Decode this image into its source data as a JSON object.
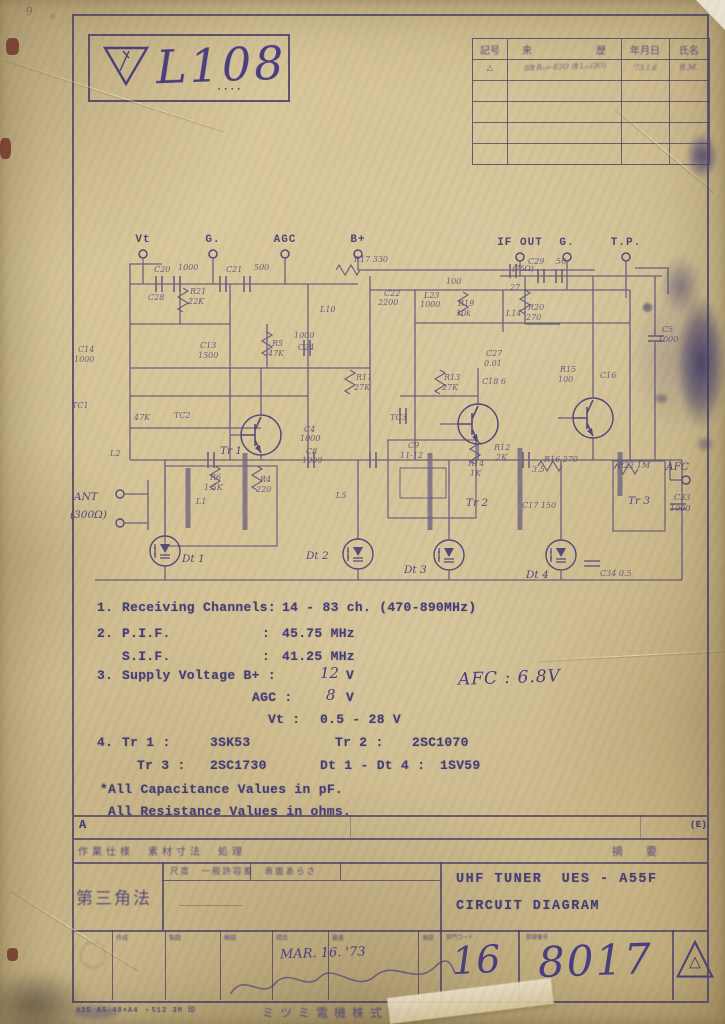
{
  "logo": {
    "number": "L108",
    "stamp_dots": "▪▪▪▪"
  },
  "margin_notes": {
    "m1": "9",
    "m2": "o"
  },
  "revision_table": {
    "headers": {
      "mark": "記号",
      "history_l": "来",
      "history_r": "歴",
      "date": "年月日",
      "name": "氏名"
    },
    "row1": {
      "mark": "△",
      "note": "ﾛ改 R₁₃←E2O 改 L₁₀(3O)",
      "date": "'73.1.6",
      "name": "R.M."
    }
  },
  "schematic": {
    "ink": "#4e4478",
    "terminals_top": [
      {
        "label": "Vt",
        "x": 73,
        "ly": 14,
        "cy": 26
      },
      {
        "label": "G.",
        "x": 143,
        "ly": 14,
        "cy": 26
      },
      {
        "label": "AGC",
        "x": 215,
        "ly": 14,
        "cy": 26
      },
      {
        "label": "B+",
        "x": 288,
        "ly": 14,
        "cy": 26
      },
      {
        "label": "IF OUT",
        "x": 450,
        "ly": 17,
        "cy": 29,
        "sub": "(75Ω)"
      },
      {
        "label": "G.",
        "x": 497,
        "ly": 17,
        "cy": 29
      },
      {
        "label": "T.P.",
        "x": 556,
        "ly": 17,
        "cy": 29
      }
    ],
    "ant": {
      "line1": "ANT",
      "line2": "(300Ω)"
    },
    "afc": {
      "label": "AFC"
    },
    "transistors": [
      {
        "label": "Tr 1",
        "cx": 191,
        "cy": 207,
        "lx": 150,
        "ly": 226
      },
      {
        "label": "Tr 2",
        "cx": 408,
        "cy": 196,
        "lx": 396,
        "ly": 278
      },
      {
        "label": "Tr 3",
        "cx": 523,
        "cy": 190,
        "lx": 558,
        "ly": 276
      }
    ],
    "diodes": [
      {
        "label": "Dt 1",
        "cx": 95,
        "cy": 323,
        "lx": 112,
        "ly": 334
      },
      {
        "label": "Dt 2",
        "cx": 288,
        "cy": 326,
        "lx": 236,
        "ly": 331
      },
      {
        "label": "Dt 3",
        "cx": 379,
        "cy": 327,
        "lx": 334,
        "ly": 345
      },
      {
        "label": "Dt 4",
        "cx": 491,
        "cy": 327,
        "lx": 456,
        "ly": 350
      }
    ],
    "labels": [
      {
        "t": "C20",
        "x": 84,
        "y": 44
      },
      {
        "t": "1000",
        "x": 108,
        "y": 42
      },
      {
        "t": "C21",
        "x": 156,
        "y": 44
      },
      {
        "t": "500",
        "x": 184,
        "y": 42
      },
      {
        "t": "R17 330",
        "x": 284,
        "y": 34
      },
      {
        "t": "C22",
        "x": 314,
        "y": 68
      },
      {
        "t": "2200",
        "x": 308,
        "y": 77
      },
      {
        "t": "L23",
        "x": 354,
        "y": 70
      },
      {
        "t": "1000",
        "x": 350,
        "y": 79
      },
      {
        "t": "100",
        "x": 376,
        "y": 56
      },
      {
        "t": "R19",
        "x": 388,
        "y": 78
      },
      {
        "t": "10k",
        "x": 386,
        "y": 88
      },
      {
        "t": "L14",
        "x": 436,
        "y": 88
      },
      {
        "t": "27",
        "x": 440,
        "y": 62
      },
      {
        "t": "C29",
        "x": 458,
        "y": 36
      },
      {
        "t": "56",
        "x": 486,
        "y": 36
      },
      {
        "t": "R20",
        "x": 458,
        "y": 82
      },
      {
        "t": "270",
        "x": 456,
        "y": 92
      },
      {
        "t": "C5",
        "x": 592,
        "y": 104
      },
      {
        "t": "1000",
        "x": 588,
        "y": 114
      },
      {
        "t": "C28",
        "x": 78,
        "y": 72
      },
      {
        "t": "R21",
        "x": 120,
        "y": 66
      },
      {
        "t": "22K",
        "x": 118,
        "y": 76
      },
      {
        "t": "C14",
        "x": 8,
        "y": 124
      },
      {
        "t": "1000",
        "x": 4,
        "y": 134
      },
      {
        "t": "C13",
        "x": 130,
        "y": 120
      },
      {
        "t": "1500",
        "x": 128,
        "y": 130
      },
      {
        "t": "R5",
        "x": 202,
        "y": 118
      },
      {
        "t": "47K",
        "x": 198,
        "y": 128
      },
      {
        "t": "1000",
        "x": 224,
        "y": 110
      },
      {
        "t": "C24",
        "x": 228,
        "y": 122
      },
      {
        "t": "L10",
        "x": 250,
        "y": 84
      },
      {
        "t": "R11",
        "x": 286,
        "y": 152
      },
      {
        "t": "27K",
        "x": 284,
        "y": 162
      },
      {
        "t": "TC1",
        "x": 2,
        "y": 180
      },
      {
        "t": "47K",
        "x": 64,
        "y": 192
      },
      {
        "t": "R13",
        "x": 374,
        "y": 152
      },
      {
        "t": "27K",
        "x": 372,
        "y": 162
      },
      {
        "t": "C27",
        "x": 416,
        "y": 128
      },
      {
        "t": "0.01",
        "x": 414,
        "y": 138
      },
      {
        "t": "C18 6",
        "x": 412,
        "y": 156
      },
      {
        "t": "R15",
        "x": 490,
        "y": 144
      },
      {
        "t": "100",
        "x": 488,
        "y": 154
      },
      {
        "t": "C16",
        "x": 530,
        "y": 150
      },
      {
        "t": "TC2",
        "x": 104,
        "y": 190
      },
      {
        "t": "TC3",
        "x": 320,
        "y": 192
      },
      {
        "t": "R6",
        "x": 140,
        "y": 252
      },
      {
        "t": "1.5K",
        "x": 134,
        "y": 262
      },
      {
        "t": "R4",
        "x": 190,
        "y": 254
      },
      {
        "t": "220",
        "x": 186,
        "y": 264
      },
      {
        "t": "C4",
        "x": 234,
        "y": 204
      },
      {
        "t": "1000",
        "x": 230,
        "y": 213
      },
      {
        "t": "C8",
        "x": 236,
        "y": 226
      },
      {
        "t": "1000",
        "x": 232,
        "y": 235
      },
      {
        "t": "L2",
        "x": 40,
        "y": 228
      },
      {
        "t": "L1",
        "x": 126,
        "y": 276
      },
      {
        "t": "L5",
        "x": 266,
        "y": 270
      },
      {
        "t": "C9",
        "x": 338,
        "y": 220
      },
      {
        "t": "11-12",
        "x": 330,
        "y": 230
      },
      {
        "t": "R14",
        "x": 398,
        "y": 238
      },
      {
        "t": "1K",
        "x": 400,
        "y": 248
      },
      {
        "t": "R12",
        "x": 424,
        "y": 222
      },
      {
        "t": "2K",
        "x": 426,
        "y": 232
      },
      {
        "t": "3.5",
        "x": 462,
        "y": 244
      },
      {
        "t": "R16 270",
        "x": 474,
        "y": 234
      },
      {
        "t": "C17 150",
        "x": 452,
        "y": 280
      },
      {
        "t": "R22 1M",
        "x": 548,
        "y": 240
      },
      {
        "t": "C33",
        "x": 604,
        "y": 272
      },
      {
        "t": "1000",
        "x": 600,
        "y": 283
      },
      {
        "t": "C34 0.5",
        "x": 530,
        "y": 348
      }
    ]
  },
  "specs": {
    "line1": {
      "num": "1.",
      "label": "Receiving Channels:",
      "value": "14 - 83 ch. (470-890MHz)"
    },
    "line2": {
      "num": "2.",
      "label": "P.I.F.",
      "colon": ":",
      "value": "45.75 MHz"
    },
    "line3": {
      "label": "S.I.F.",
      "colon": ":",
      "value": "41.25 MHz"
    },
    "line4": {
      "num": "3.",
      "label": "Supply Voltage B+ :",
      "hand": "12",
      "unit": "V"
    },
    "line5": {
      "label": "AGC :",
      "hand": "8",
      "unit": "V"
    },
    "line6": {
      "label": "Vt :",
      "value": "0.5 - 28 V"
    },
    "line7": {
      "num": "4.",
      "label": "Tr 1 :",
      "value": "3SK53",
      "label2": "Tr 2 :",
      "value2": "2SC1070"
    },
    "line8": {
      "label": "Tr 3 :",
      "value": "2SC1730",
      "label2": "Dt 1 - Dt 4 :",
      "value2": "1SV59"
    },
    "note1": "*All Capacitance Values in pF.",
    "note2": "All Resistance Values in ohms.",
    "afc_hand": "AFC : 6.8V"
  },
  "titleblock": {
    "row_a_label": "A",
    "process_row": "作業仕様　素材寸法　処理",
    "remark_label": "摘　要",
    "corner_note": "(E)",
    "projection_label": "第三角法",
    "scale_header": "尺度　一般許容差　表面あらさ",
    "title_line1": "UHF TUNER  UES - A55F",
    "title_line2": "CIRCUIT DIAGRAM",
    "sign_headers": [
      "作成",
      "製図",
      "検図",
      "照合",
      "審査",
      "承認"
    ],
    "dept_code_label": "部門コード",
    "dept_code": "16",
    "dwg_no_label": "登録番号",
    "dwg_no": "8017",
    "date_hand": "MAR. 16. '73",
    "footer_print": "#25 A5-48×A4 ・512 3M 印",
    "company": "ミツミ電機株式会社"
  }
}
